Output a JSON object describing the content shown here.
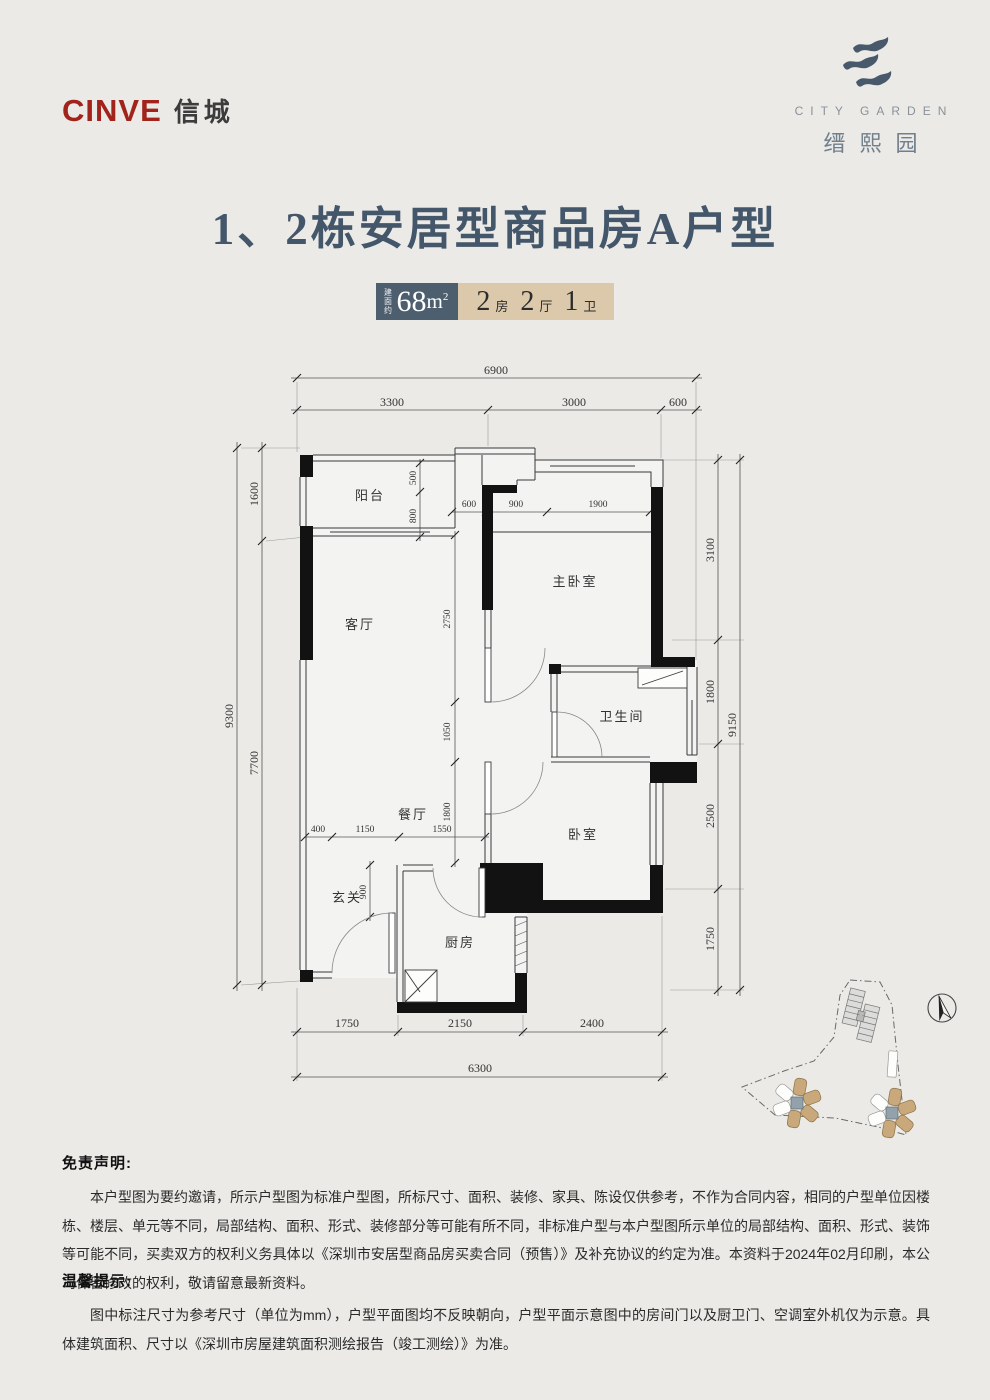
{
  "header": {
    "brand_left": {
      "en": "CINVE",
      "cn": "信城"
    },
    "brand_right": {
      "en": "CITY GARDEN",
      "cn": "缙熙园"
    }
  },
  "title": "1、2栋安居型商品房A户型",
  "badge": {
    "area_label": "建面约",
    "area_value": "68",
    "area_unit": "m",
    "area_sup": "2",
    "layout": [
      {
        "num": "2",
        "unit": "房"
      },
      {
        "num": "2",
        "unit": "厅"
      },
      {
        "num": "1",
        "unit": "卫"
      }
    ]
  },
  "floorplan": {
    "rooms": {
      "balcony": "阳台",
      "living": "客厅",
      "master": "主卧室",
      "bath": "卫生间",
      "dining": "餐厅",
      "bedroom": "卧室",
      "foyer": "玄关",
      "kitchen": "厨房"
    },
    "dims": {
      "top_total": "6900",
      "top": [
        "3300",
        "3000",
        "600"
      ],
      "left_total": "9300",
      "left": [
        "1600",
        "7700"
      ],
      "right_total": "9150",
      "right": [
        "3100",
        "1800",
        "2500",
        "1750"
      ],
      "bottom_total": "6300",
      "bottom": [
        "1750",
        "2150",
        "2400"
      ],
      "balcony": [
        "500",
        "800"
      ],
      "master_top": [
        "600",
        "900",
        "1900"
      ],
      "center": [
        "2750",
        "1050",
        "1800"
      ],
      "dining": [
        "400",
        "1150",
        "1550"
      ],
      "foyer": "900"
    }
  },
  "disclaimer": {
    "title": "免责声明:",
    "body": "本户型图为要约邀请，所示户型图为标准户型图，所标尺寸、面积、装修、家具、陈设仅供参考，不作为合同内容，相同的户型单位因楼栋、楼层、单元等不同，局部结构、面积、形式、装修部分等可能有所不同，非标准户型与本户型图所示单位的局部结构、面积、形式、装饰等可能不同，买卖双方的权利义务具体以《深圳市安居型商品房买卖合同（预售）》及补充协议的约定为准。本资料于2024年02月印刷，本公司保留修改的权利，敬请留意最新资料。"
  },
  "tips": {
    "title": "温馨提示:",
    "body": "图中标注尺寸为参考尺寸（单位为mm），户型平面图均不反映朝向，户型平面示意图中的房间门以及厨卫门、空调室外机仅为示意。具体建筑面积、尺寸以《深圳市房屋建筑面积测绘报告（竣工测绘）》为准。"
  }
}
